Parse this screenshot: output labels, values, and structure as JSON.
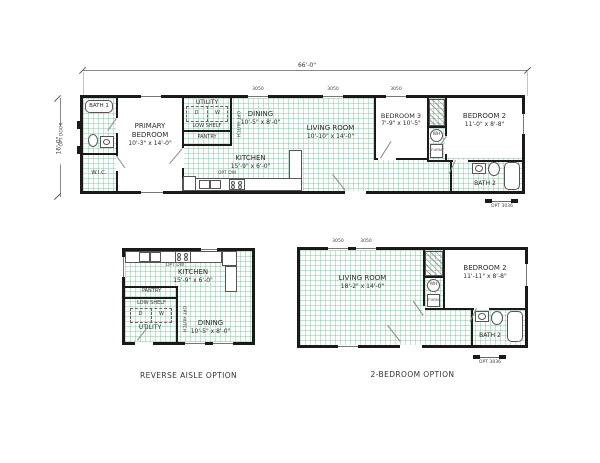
{
  "symbols": {
    "washer": "W",
    "dryer": "D",
    "low_shelf": "LOW SHELF",
    "pantry": "PANTRY",
    "opt_hutch": "OPT HUTCH",
    "water_heater": "WH",
    "furnace": "FURN",
    "opt_dw": "OPT DW",
    "window_size": "3050",
    "opt_window": "OPT 3036",
    "opt_door": "OPT DOOR"
  },
  "plans": {
    "main": {
      "dim_width": "66'-0\"",
      "dim_height": "16'-0\"",
      "rooms": {
        "bath1": {
          "name": "BATH 1"
        },
        "primary": {
          "name": "PRIMARY BEDROOM",
          "size": "10'-3\" x 14'-0\""
        },
        "wic": {
          "name": "W.I.C."
        },
        "utility": {
          "name": "UTILITY"
        },
        "dining": {
          "name": "DINING",
          "size": "10'-5\" x 8'-0\""
        },
        "kitchen": {
          "name": "KITCHEN",
          "size": "15'-9\" x 6'-0\""
        },
        "living": {
          "name": "LIVING ROOM",
          "size": "10'-10\" x 14'-0\""
        },
        "bed3": {
          "name": "BEDROOM 3",
          "size": "7'-9\" x 10'-5\""
        },
        "bed2": {
          "name": "BEDROOM 2",
          "size": "11'-0\" x 8'-8\""
        },
        "bath2": {
          "name": "BATH 2"
        }
      }
    },
    "reverse": {
      "caption": "REVERSE AISLE OPTION",
      "rooms": {
        "kitchen": {
          "name": "KITCHEN",
          "size": "15'-9\" x 6'-0\""
        },
        "utility": {
          "name": "UTILITY"
        },
        "dining": {
          "name": "DINING",
          "size": "10'-5\" x 8'-0\""
        }
      }
    },
    "twobed": {
      "caption": "2-BEDROOM OPTION",
      "rooms": {
        "living": {
          "name": "LIVING ROOM",
          "size": "18'-2\" x 14'-0\""
        },
        "bed2": {
          "name": "BEDROOM 2",
          "size": "11'-11\" x 8'-8\""
        },
        "bath2": {
          "name": "BATH 2"
        }
      }
    }
  }
}
